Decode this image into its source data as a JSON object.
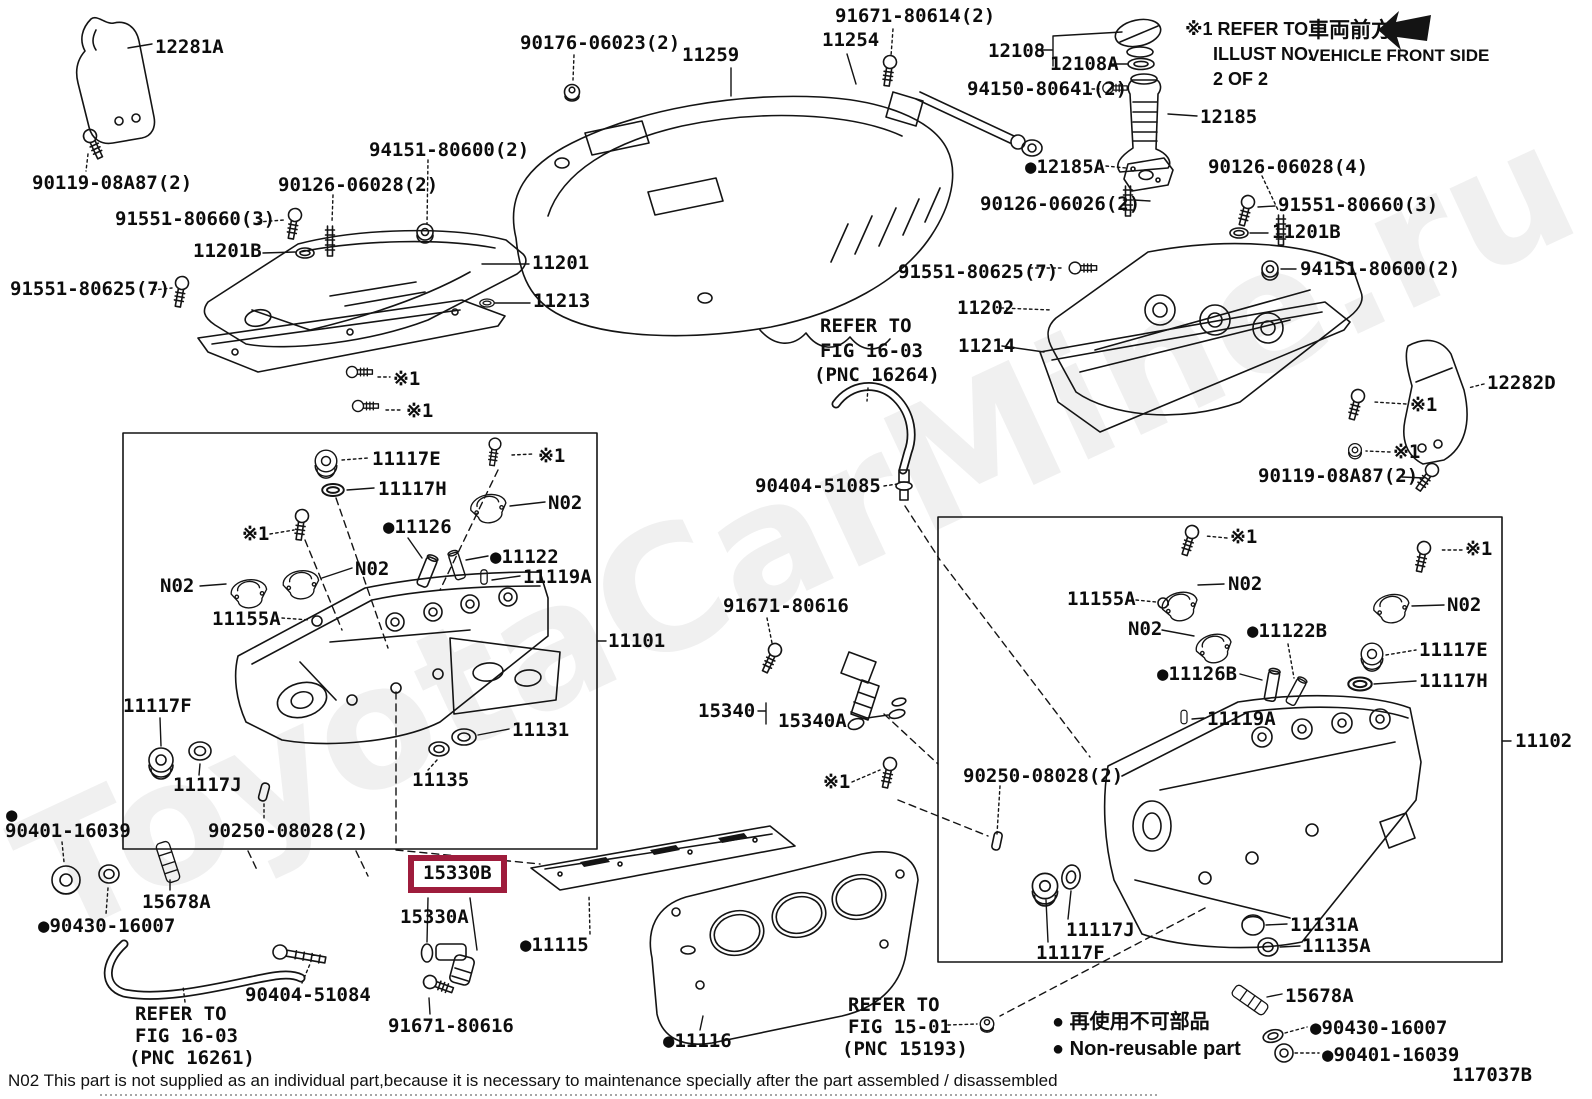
{
  "page": {
    "width": 1592,
    "height": 1099,
    "background": "#ffffff",
    "figure_code": "117037B",
    "watermark": "ToyotaCarMine.ru"
  },
  "colors": {
    "ink": "#141414",
    "highlight_box": "#9e1c3c",
    "watermark": "rgba(40,40,40,0.07)"
  },
  "header": {
    "illust_note_lines": [
      "※1 REFER TO",
      "ILLUST NO.",
      "2 OF 2"
    ],
    "vehicle_front_jp": "車両前方",
    "vehicle_front_en": "VEHICLE FRONT SIDE"
  },
  "legend": {
    "jp": "● 再使用不可部品",
    "en": "● Non-reusable part"
  },
  "footer": {
    "note": "N02 This part is not supplied as an individual part,because it is necessary to maintenance specially after the part assembled / disassembled"
  },
  "labels": [
    {
      "t": "12281A",
      "x": 155,
      "y": 38,
      "i": 1
    },
    {
      "t": "90119-08A87(2)",
      "x": 32,
      "y": 174,
      "i": 1
    },
    {
      "t": "91551-80660(3)",
      "x": 115,
      "y": 210,
      "i": 1
    },
    {
      "t": "11201B",
      "x": 193,
      "y": 242,
      "i": 1
    },
    {
      "t": "90126-06028(2)",
      "x": 278,
      "y": 176,
      "i": 1
    },
    {
      "t": "94151-80600(2)",
      "x": 369,
      "y": 141,
      "i": 1
    },
    {
      "t": "91551-80625(7)",
      "x": 10,
      "y": 280,
      "i": 1
    },
    {
      "t": "11201",
      "x": 532,
      "y": 254,
      "i": 1
    },
    {
      "t": "11213",
      "x": 533,
      "y": 292,
      "i": 1
    },
    {
      "t": "90176-06023(2)",
      "x": 520,
      "y": 34,
      "i": 1
    },
    {
      "t": "11259",
      "x": 682,
      "y": 46,
      "i": 1
    },
    {
      "t": "11254",
      "x": 822,
      "y": 31,
      "i": 1
    },
    {
      "t": "91671-80614(2)",
      "x": 835,
      "y": 7,
      "i": 1
    },
    {
      "t": "12108",
      "x": 988,
      "y": 42,
      "i": 1
    },
    {
      "t": "12108A",
      "x": 1050,
      "y": 55,
      "i": 1
    },
    {
      "t": "94150-80641(2)",
      "x": 967,
      "y": 80,
      "i": 1
    },
    {
      "t": "12185",
      "x": 1200,
      "y": 108,
      "i": 1
    },
    {
      "t": "●12185A",
      "x": 1025,
      "y": 158,
      "i": 1
    },
    {
      "t": "90126-06028(4)",
      "x": 1208,
      "y": 158,
      "i": 1
    },
    {
      "t": "90126-06026(2)",
      "x": 980,
      "y": 195,
      "i": 1
    },
    {
      "t": "91551-80660(3)",
      "x": 1278,
      "y": 196,
      "i": 1
    },
    {
      "t": "11201B",
      "x": 1272,
      "y": 223,
      "i": 1
    },
    {
      "t": "94151-80600(2)",
      "x": 1300,
      "y": 260,
      "i": 1
    },
    {
      "t": "91551-80625(7)",
      "x": 898,
      "y": 263,
      "i": 1
    },
    {
      "t": "11202",
      "x": 957,
      "y": 299,
      "i": 1
    },
    {
      "t": "11214",
      "x": 958,
      "y": 337,
      "i": 1
    },
    {
      "t": "12282D",
      "x": 1487,
      "y": 374,
      "i": 1
    },
    {
      "t": "※1",
      "x": 1410,
      "y": 396
    },
    {
      "t": "※1",
      "x": 1393,
      "y": 443
    },
    {
      "t": "90119-08A87(2)",
      "x": 1258,
      "y": 467,
      "i": 1
    },
    {
      "t": "※1",
      "x": 393,
      "y": 370
    },
    {
      "t": "※1",
      "x": 406,
      "y": 402
    },
    {
      "t": "REFER TO",
      "x": 820,
      "y": 317
    },
    {
      "t": "FIG 16-03",
      "x": 820,
      "y": 342
    },
    {
      "t": "(PNC 16264)",
      "x": 814,
      "y": 366
    },
    {
      "t": "90404-51085",
      "x": 755,
      "y": 477,
      "i": 1
    },
    {
      "t": "91671-80616",
      "x": 723,
      "y": 597,
      "i": 1
    },
    {
      "t": "15340",
      "x": 698,
      "y": 702,
      "i": 1
    },
    {
      "t": "15340A",
      "x": 778,
      "y": 712,
      "i": 1
    },
    {
      "t": "※1",
      "x": 823,
      "y": 773
    },
    {
      "t": "90250-08028(2)",
      "x": 963,
      "y": 767,
      "i": 1
    },
    {
      "t": "11117E",
      "x": 372,
      "y": 450,
      "i": 1
    },
    {
      "t": "11117H",
      "x": 378,
      "y": 480,
      "i": 1
    },
    {
      "t": "※1",
      "x": 538,
      "y": 447
    },
    {
      "t": "N02",
      "x": 548,
      "y": 494
    },
    {
      "t": "※1",
      "x": 242,
      "y": 525
    },
    {
      "t": "●11126",
      "x": 383,
      "y": 518,
      "i": 1
    },
    {
      "t": "N02",
      "x": 355,
      "y": 560
    },
    {
      "t": "●11122",
      "x": 490,
      "y": 548,
      "i": 1
    },
    {
      "t": "11119A",
      "x": 523,
      "y": 568,
      "i": 1
    },
    {
      "t": "N02",
      "x": 160,
      "y": 577
    },
    {
      "t": "11155A",
      "x": 212,
      "y": 610,
      "i": 1
    },
    {
      "t": "11101",
      "x": 608,
      "y": 632,
      "i": 1
    },
    {
      "t": "11117F",
      "x": 123,
      "y": 697,
      "i": 1
    },
    {
      "t": "11117J",
      "x": 173,
      "y": 776,
      "i": 1
    },
    {
      "t": "11131",
      "x": 512,
      "y": 721,
      "i": 1
    },
    {
      "t": "11135",
      "x": 412,
      "y": 771,
      "i": 1
    },
    {
      "t": "90250-08028(2)",
      "x": 208,
      "y": 822,
      "i": 1
    },
    {
      "t": "●",
      "x": 6,
      "y": 806
    },
    {
      "t": "90401-16039",
      "x": 5,
      "y": 822,
      "i": 1
    },
    {
      "t": "15678A",
      "x": 142,
      "y": 893,
      "i": 1
    },
    {
      "t": "●90430-16007",
      "x": 38,
      "y": 917,
      "i": 1
    },
    {
      "t": "90404-51084",
      "x": 245,
      "y": 986,
      "i": 1
    },
    {
      "t": "REFER TO",
      "x": 135,
      "y": 1005
    },
    {
      "t": "FIG 16-03",
      "x": 135,
      "y": 1027
    },
    {
      "t": "(PNC 16261)",
      "x": 129,
      "y": 1049
    },
    {
      "t": "15330B",
      "x": 408,
      "y": 855,
      "i": 1,
      "hi": 1
    },
    {
      "t": "15330A",
      "x": 400,
      "y": 908,
      "i": 1
    },
    {
      "t": "91671-80616",
      "x": 388,
      "y": 1017,
      "i": 1
    },
    {
      "t": "●11115",
      "x": 520,
      "y": 936,
      "i": 1
    },
    {
      "t": "●11116",
      "x": 663,
      "y": 1032,
      "i": 1
    },
    {
      "t": "※1",
      "x": 1230,
      "y": 528
    },
    {
      "t": "※1",
      "x": 1465,
      "y": 540
    },
    {
      "t": "11155A",
      "x": 1067,
      "y": 590,
      "i": 1
    },
    {
      "t": "N02",
      "x": 1228,
      "y": 575
    },
    {
      "t": "N02",
      "x": 1128,
      "y": 620
    },
    {
      "t": "N02",
      "x": 1447,
      "y": 596
    },
    {
      "t": "●11122B",
      "x": 1247,
      "y": 622,
      "i": 1
    },
    {
      "t": "●11126B",
      "x": 1157,
      "y": 665,
      "i": 1
    },
    {
      "t": "11117E",
      "x": 1419,
      "y": 641,
      "i": 1
    },
    {
      "t": "11117H",
      "x": 1419,
      "y": 672,
      "i": 1
    },
    {
      "t": "11119A",
      "x": 1207,
      "y": 710,
      "i": 1
    },
    {
      "t": "11102",
      "x": 1515,
      "y": 732,
      "i": 1
    },
    {
      "t": "11117J",
      "x": 1066,
      "y": 921,
      "i": 1
    },
    {
      "t": "11117F",
      "x": 1036,
      "y": 944,
      "i": 1
    },
    {
      "t": "11131A",
      "x": 1290,
      "y": 916,
      "i": 1
    },
    {
      "t": "11135A",
      "x": 1302,
      "y": 937,
      "i": 1
    },
    {
      "t": "15678A",
      "x": 1285,
      "y": 987,
      "i": 1
    },
    {
      "t": "●90430-16007",
      "x": 1310,
      "y": 1019,
      "i": 1
    },
    {
      "t": "●90401-16039",
      "x": 1322,
      "y": 1046,
      "i": 1
    },
    {
      "t": "REFER TO",
      "x": 848,
      "y": 996
    },
    {
      "t": "FIG 15-01",
      "x": 848,
      "y": 1018
    },
    {
      "t": "(PNC 15193)",
      "x": 842,
      "y": 1040
    }
  ]
}
